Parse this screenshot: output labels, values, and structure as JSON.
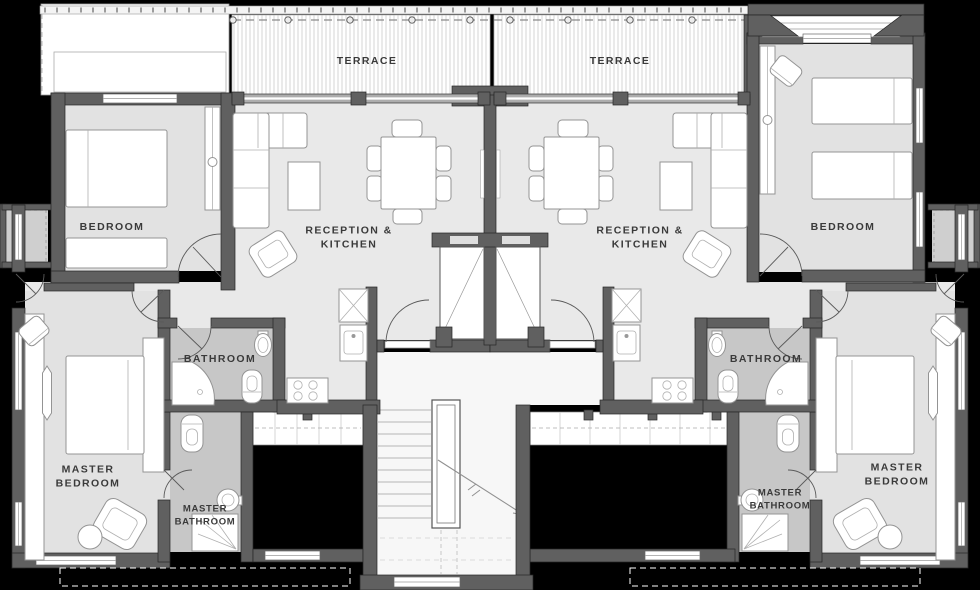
{
  "rooms": {
    "terrace_left": {
      "label": "TERRACE"
    },
    "terrace_right": {
      "label": "TERRACE"
    },
    "reception_left": {
      "label": "RECEPTION &\nKITCHEN"
    },
    "reception_right": {
      "label": "RECEPTION &\nKITCHEN"
    },
    "bedroom_left": {
      "label": "BEDROOM"
    },
    "bedroom_right": {
      "label": "BEDROOM"
    },
    "bathroom_left": {
      "label": "BATHROOM"
    },
    "bathroom_right": {
      "label": "BATHROOM"
    },
    "master_bedroom_left": {
      "label": "MASTER\nBEDROOM"
    },
    "master_bedroom_right": {
      "label": "MASTER\nBEDROOM"
    },
    "master_bathroom_left": {
      "label": "MASTER\nBATHROOM"
    },
    "master_bathroom_right": {
      "label": "MASTER\nBATHROOM"
    }
  },
  "colors": {
    "background": "#000000",
    "wall": "#606060",
    "floor": "#e9e9e9",
    "floor_bedroom": "#e2e2e2",
    "floor_bath": "#c7c7c7",
    "furniture": "#ffffff",
    "label": "#3a3a3a"
  }
}
